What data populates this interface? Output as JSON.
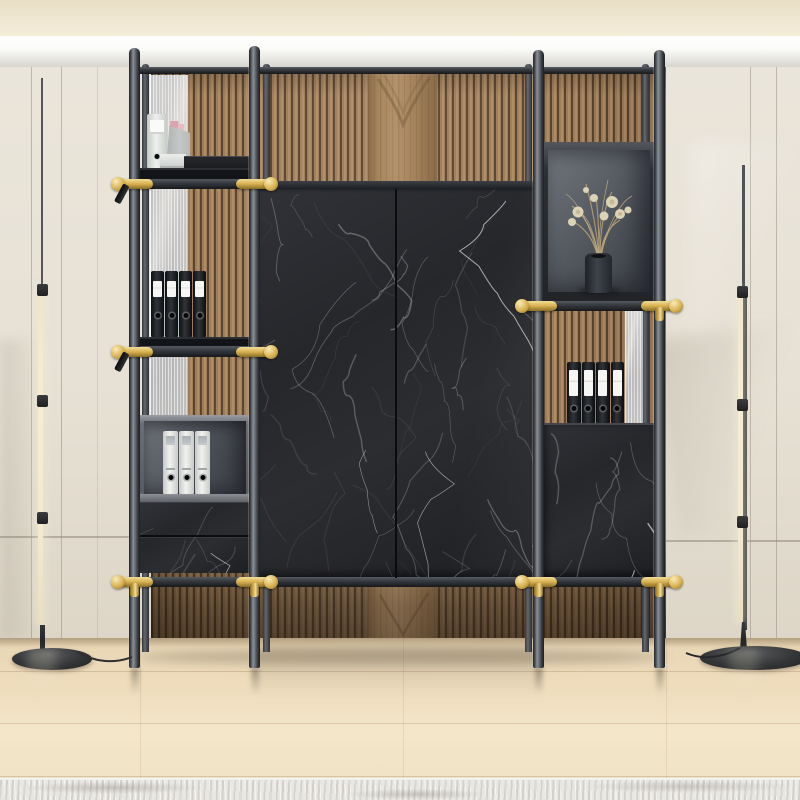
{
  "meta": {
    "domain": "natural-image",
    "description": "Interior photo: black marble modular wall shelving unit with brass connectors on a wood-slat accent wall, flanked by cream wardrobe walls and two linear LED floor lamps on a light maple floor."
  },
  "palette": {
    "ceiling_cream1": "#e9dfc6",
    "ceiling_cream2": "#f4edda",
    "molding_hi": "#ffffff",
    "molding_lo": "#d6d4ce",
    "wall_cream": "#eae5da",
    "wall_cream_dk": "#ddd6c7",
    "seam": "#8f897c",
    "slat_groove": "#5a452f",
    "slat_face": "#a07d59",
    "slat_hi": "#bb9b76",
    "plain_wood": "#b3926b",
    "plain_wood_dk": "#8a6b49",
    "marble_a": "#313237",
    "marble_b": "#1e1f23",
    "vein": "#ebedf0",
    "pole_dk": "#212428",
    "pole_md": "#4b5056",
    "pole_hi": "#8a9097",
    "rail_hi": "#565b62",
    "rail_dk": "#17181b",
    "slab": "#121417",
    "frame_gray": "#6b6f75",
    "frame_gray_hi": "#9a9ea3",
    "niche_hi": "#71767d",
    "niche_lo": "#3b3f46",
    "gold": "#d9b254",
    "gold_light": "#f2dd96",
    "gold_dark": "#8a6d25",
    "binder_black": "#0e1012",
    "label_white": "#f6f6f4",
    "binder_white": "#f2f3f0",
    "binder_white_dk": "#c7c9c6",
    "folder_gray": "#c3c7c6",
    "book_pink": "#dba3ab",
    "vase_dk": "#1e2125",
    "vase_md": "#3e444c",
    "flower_stem": "#b9a177",
    "flower_bloom": "#dcd2b6",
    "glass_hi": "#e6e9ec",
    "glass_lo": "#c2c7cc",
    "floor_1": "#e9d7b6",
    "floor_2": "#f4e6c9",
    "floor_dk": "#d9c4a0",
    "rug": "#e9e7e2",
    "led": "#f6ecd2",
    "lamp_base": "#202224"
  },
  "scene": {
    "ceiling": {
      "style": "cream band with white crown molding"
    },
    "accent_wall": {
      "material": "walnut wood slats",
      "plain_board_column": true
    },
    "side_walls": {
      "material": "cream wardrobe panels",
      "left_vertical_seams": 3,
      "right_vertical_seams": 2,
      "horizontal_seam": true
    },
    "floor": {
      "material": "light maple planks"
    },
    "rug": {
      "style": "mottled gray-white",
      "position": "bottom edge"
    }
  },
  "unit": {
    "poles": {
      "front": 4,
      "back": 4,
      "finish": "graphite metal",
      "mount": "floor-to-ceiling"
    },
    "connectors": {
      "finish": "brass",
      "visible": 10
    },
    "left_column": {
      "top_shelf": {
        "white_binder": 1,
        "flat_white_binder": 1,
        "gray_folder": 1,
        "pink_books": 2,
        "black_box": 1
      },
      "shelf2_black_binders": 4,
      "open_box_white_binders": 3,
      "drawer_count": 2
    },
    "center_cabinet": {
      "doors": 2,
      "material": "black marquina marble"
    },
    "right_column": {
      "display_niche": {
        "vase": 1,
        "contents": "dried flowers"
      },
      "black_binders": 4,
      "base_cabinet": {
        "material": "black marquina marble"
      }
    }
  },
  "lamps": {
    "left": {
      "type": "linear LED floor lamp",
      "state": "on",
      "segments": 3
    },
    "right": {
      "type": "linear LED floor lamp",
      "state": "on",
      "segments": 3
    }
  }
}
